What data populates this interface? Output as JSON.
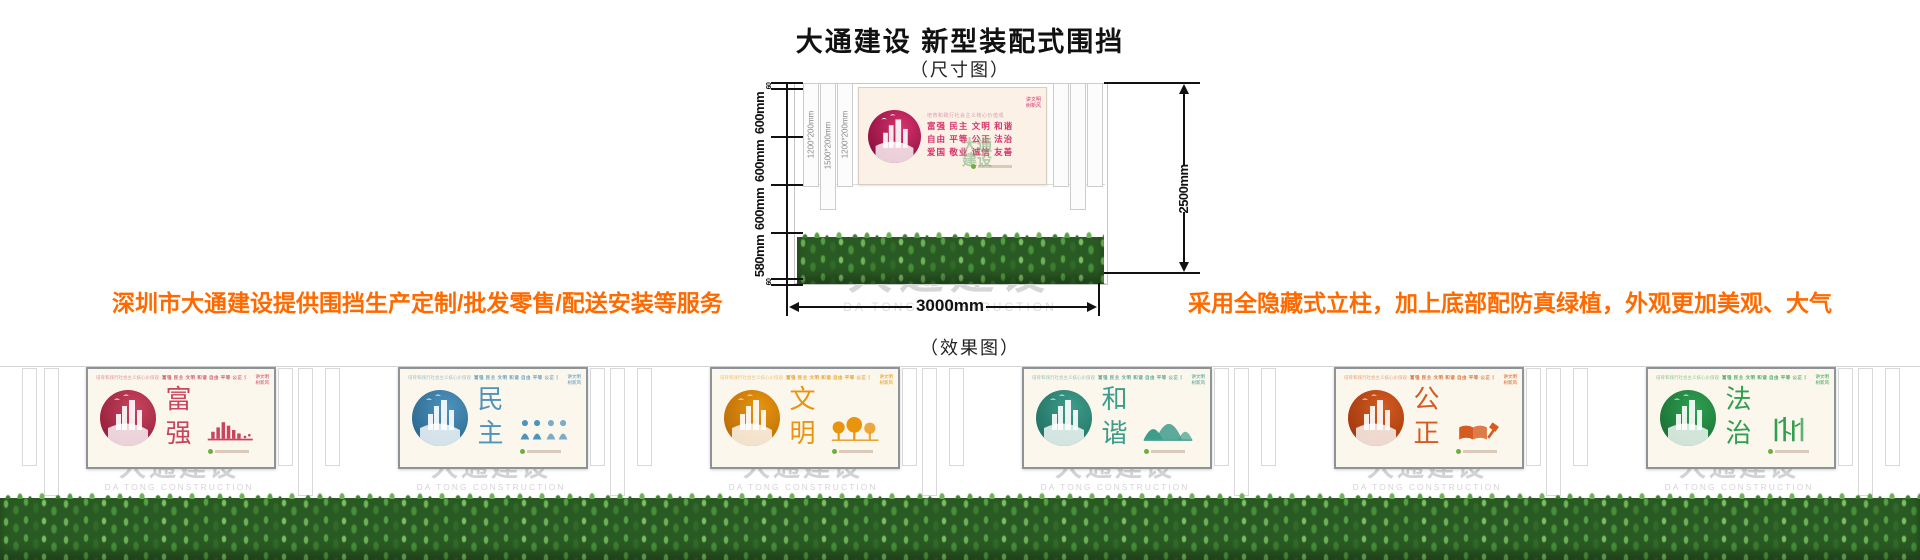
{
  "header": {
    "title": "大通建设 新型装配式围挡",
    "subtitle": "（尺寸图）"
  },
  "dimension_diagram": {
    "left_dims": [
      "60",
      "600mm",
      "600mm",
      "600mm",
      "580mm",
      "60"
    ],
    "right_dim": "2500mm",
    "bottom_dim": "3000mm",
    "post_labels": [
      "1200*200mm",
      "1500*200mm",
      "1200*200mm"
    ],
    "banner": {
      "tagline": "培育和践行社会主义核心价值观",
      "values_rows": [
        "富强  民主  文明  和谐",
        "自由  平等  公正  法治",
        "爱国  敬业  诚信  友善"
      ],
      "corner_lines": [
        "讲文明",
        "树新风"
      ]
    },
    "watermark": {
      "cn": "大通建设",
      "en": "DA TONG CONSTRUCTION"
    },
    "mini_watermark": "大通 建设"
  },
  "notes": {
    "left": "深圳市大通建设提供围挡生产定制/批发零售/配送安装等服务",
    "right": "采用全隐藏式立柱，加上底部配防真绿植，外观更加美观、大气",
    "color": "#FF6A00"
  },
  "effect": {
    "label": "（效果图）",
    "tagline": "培育和践行社会主义核心价值观",
    "values_line": "富强 民主 文明 和谐 自由 平等 公正 法治 爱国 敬业 诚信 友善",
    "corner_lines": [
      "讲文明",
      "树新风"
    ],
    "watermark": {
      "cn": "大通建设",
      "en": "DA TONG CONSTRUCTION"
    },
    "grass_colors": [
      "#2a5a23",
      "#55a043",
      "#6db356"
    ],
    "panels": [
      {
        "title": "富强",
        "color": "#C9445C",
        "dark": "#97203E"
      },
      {
        "title": "民主",
        "color": "#4E93BC",
        "dark": "#2C6A92"
      },
      {
        "title": "文明",
        "color": "#E8940F",
        "dark": "#BB6E07"
      },
      {
        "title": "和谐",
        "color": "#3E9C8B",
        "dark": "#237465"
      },
      {
        "title": "公正",
        "color": "#D55B20",
        "dark": "#A23A0E"
      },
      {
        "title": "法治",
        "color": "#2FA050",
        "dark": "#1B7236"
      }
    ]
  }
}
